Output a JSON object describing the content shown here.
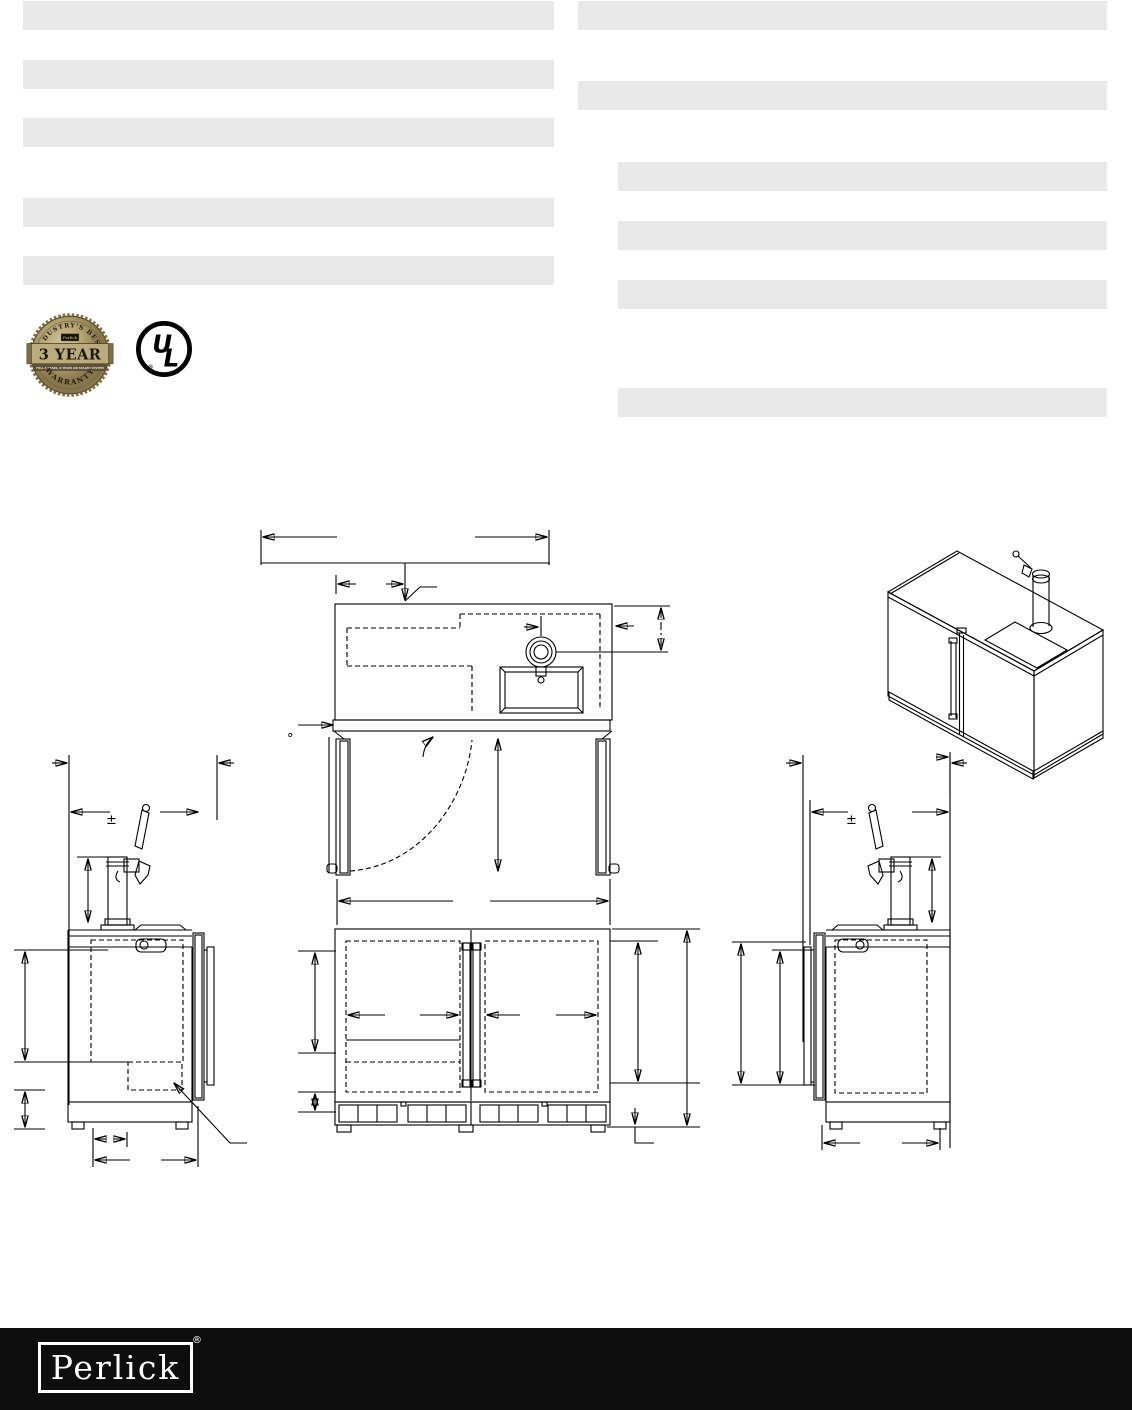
{
  "page": {
    "width": 1132,
    "height": 1410,
    "background": "#ffffff"
  },
  "colors": {
    "redaction_bar": "#e9e9e9",
    "line": "#000000",
    "footer_bg": "#0e0e0e",
    "badge_gold_light": "#cdbb92",
    "badge_gold": "#b3a274",
    "badge_gold_dark": "#8a7850",
    "badge_text": "#241c10"
  },
  "redactions": {
    "bar_height": 29,
    "columns": [
      {
        "name": "left-column",
        "x": 23,
        "width": 531,
        "bar_y": [
          1,
          60,
          118,
          198,
          256
        ]
      },
      {
        "name": "right-column-full",
        "x": 578,
        "width": 529,
        "bar_y": [
          1,
          81
        ]
      },
      {
        "name": "right-column-indented",
        "x": 618,
        "width": 489,
        "bar_y": [
          162,
          221,
          280,
          388
        ]
      }
    ]
  },
  "badges": {
    "warranty": {
      "arc_top": "INDUSTRY'S BEST",
      "plaque": "Perlick",
      "headline": "3 YEAR",
      "subline": "FULL 3 YEARS, 6 YEARS ON SEALED SYSTEM",
      "arc_bottom": "WARRANTY"
    },
    "ul": {
      "letters_u": "U",
      "letters_l": "L",
      "registered": "®"
    }
  },
  "drawing_symbols": {
    "tolerance_left": "±",
    "tolerance_right": "±",
    "door_swing_degree": "°"
  },
  "footer": {
    "logo_text": "Perlick",
    "registered": "®"
  }
}
